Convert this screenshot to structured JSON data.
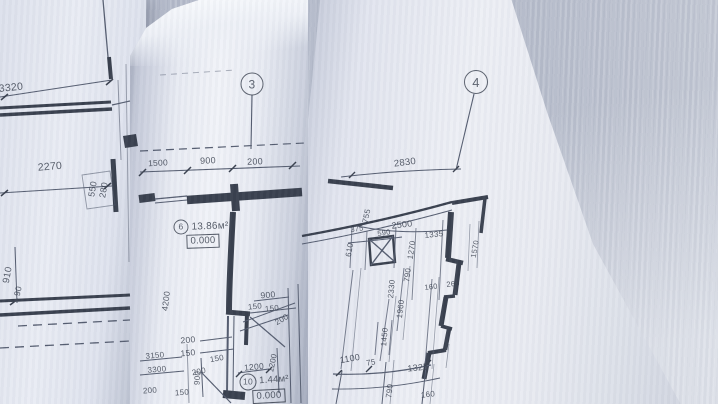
{
  "colors": {
    "background": "#b7bdcc",
    "paper_bright": "#f0f2f8",
    "paper": "#e7eaf3",
    "paper_shadow": "#a8aebf",
    "ink_dark": "#39404e",
    "ink_thin": "#555d70"
  },
  "sheets": {
    "left": {
      "labels": [
        {
          "text": "3320",
          "x": 11,
          "y": 88,
          "rot": -6,
          "size": 10.5
        },
        {
          "text": "2270",
          "x": 50,
          "y": 167,
          "rot": -5,
          "size": 10.5
        },
        {
          "text": "550",
          "x": 93,
          "y": 189,
          "rot": -80,
          "size": 9
        },
        {
          "text": "280",
          "x": 104,
          "y": 190,
          "rot": -80,
          "size": 9
        },
        {
          "text": "910",
          "x": 8,
          "y": 275,
          "rot": -80,
          "size": 9.5
        },
        {
          "text": "90",
          "x": 18,
          "y": 291,
          "rot": -78,
          "size": 8.5
        }
      ]
    },
    "middle": {
      "labels": [
        {
          "text": "3",
          "x": 252,
          "y": 84,
          "rot": 0,
          "size": 12,
          "kind": "axis",
          "d": 21,
          "name": "axis-marker-3"
        },
        {
          "text": "1500",
          "x": 158,
          "y": 163,
          "rot": -3,
          "size": 8.5
        },
        {
          "text": "900",
          "x": 208,
          "y": 161,
          "rot": -3,
          "size": 9
        },
        {
          "text": "200",
          "x": 255,
          "y": 162,
          "rot": -2,
          "size": 9
        },
        {
          "text": "6",
          "x": 181,
          "y": 227,
          "rot": 0,
          "size": 8.5,
          "kind": "circle",
          "d": 13,
          "name": "room-number-6"
        },
        {
          "text": "13.86м²",
          "x": 210,
          "y": 227,
          "rot": -2,
          "size": 10,
          "kind": "area",
          "name": "room-area-label"
        },
        {
          "text": "0.000",
          "x": 203,
          "y": 241,
          "rot": -2,
          "size": 9.5,
          "kind": "level",
          "name": "level-mark"
        },
        {
          "text": "4200",
          "x": 166,
          "y": 301,
          "rot": -83,
          "size": 8.5
        },
        {
          "text": "900",
          "x": 268,
          "y": 295,
          "rot": -5,
          "size": 8.5
        },
        {
          "text": "150",
          "x": 255,
          "y": 307,
          "rot": -5,
          "size": 8
        },
        {
          "text": "150",
          "x": 272,
          "y": 309,
          "rot": -5,
          "size": 8
        },
        {
          "text": "200",
          "x": 282,
          "y": 320,
          "rot": -30,
          "size": 8
        },
        {
          "text": "200",
          "x": 188,
          "y": 340,
          "rot": -5,
          "size": 8.5
        },
        {
          "text": "150",
          "x": 188,
          "y": 353,
          "rot": -5,
          "size": 8.5
        },
        {
          "text": "150",
          "x": 217,
          "y": 359,
          "rot": -10,
          "size": 8
        },
        {
          "text": "3150",
          "x": 155,
          "y": 356,
          "rot": -5,
          "size": 8
        },
        {
          "text": "3300",
          "x": 157,
          "y": 370,
          "rot": -5,
          "size": 8
        },
        {
          "text": "200",
          "x": 150,
          "y": 391,
          "rot": -4,
          "size": 8
        },
        {
          "text": "150",
          "x": 182,
          "y": 393,
          "rot": -4,
          "size": 8
        },
        {
          "text": "200",
          "x": 199,
          "y": 372,
          "rot": -12,
          "size": 8
        },
        {
          "text": "900",
          "x": 198,
          "y": 378,
          "rot": -85,
          "size": 8
        },
        {
          "text": "1200",
          "x": 254,
          "y": 367,
          "rot": -5,
          "size": 8.5
        },
        {
          "text": "1200",
          "x": 273,
          "y": 363,
          "rot": -78,
          "size": 8
        },
        {
          "text": "10",
          "x": 248,
          "y": 382,
          "rot": 0,
          "size": 8.5,
          "kind": "circle",
          "d": 15,
          "name": "room-number-10"
        },
        {
          "text": "1.44м²",
          "x": 274,
          "y": 380,
          "rot": -4,
          "size": 9.5,
          "kind": "area",
          "name": "room-area-label"
        },
        {
          "text": "0.000",
          "x": 269,
          "y": 396,
          "rot": -3,
          "size": 9.5,
          "kind": "level",
          "name": "level-mark"
        }
      ]
    },
    "right": {
      "labels": [
        {
          "text": "4",
          "x": 476,
          "y": 82,
          "rot": 0,
          "size": 13,
          "kind": "axis",
          "d": 22,
          "name": "axis-marker-4"
        },
        {
          "text": "2830",
          "x": 405,
          "y": 163,
          "rot": -7,
          "size": 9.5
        },
        {
          "text": "755",
          "x": 367,
          "y": 216,
          "rot": -78,
          "size": 8
        },
        {
          "text": "375",
          "x": 357,
          "y": 229,
          "rot": -8,
          "size": 7.5
        },
        {
          "text": "590",
          "x": 384,
          "y": 233,
          "rot": -8,
          "size": 7.5
        },
        {
          "text": "2500",
          "x": 402,
          "y": 225,
          "rot": -7,
          "size": 9
        },
        {
          "text": "1335",
          "x": 434,
          "y": 235,
          "rot": -6,
          "size": 8
        },
        {
          "text": "610",
          "x": 350,
          "y": 250,
          "rot": -80,
          "size": 8
        },
        {
          "text": "1270",
          "x": 412,
          "y": 250,
          "rot": -82,
          "size": 8
        },
        {
          "text": "790",
          "x": 408,
          "y": 275,
          "rot": -82,
          "size": 8
        },
        {
          "text": "2330",
          "x": 392,
          "y": 289,
          "rot": -85,
          "size": 8
        },
        {
          "text": "160",
          "x": 431,
          "y": 287,
          "rot": -7,
          "size": 7.5
        },
        {
          "text": "260",
          "x": 453,
          "y": 284,
          "rot": -7,
          "size": 7.5
        },
        {
          "text": "1570",
          "x": 475,
          "y": 249,
          "rot": -80,
          "size": 7.5
        },
        {
          "text": "1960",
          "x": 401,
          "y": 309,
          "rot": -83,
          "size": 8
        },
        {
          "text": "1450",
          "x": 385,
          "y": 337,
          "rot": -85,
          "size": 8
        },
        {
          "text": "1100",
          "x": 350,
          "y": 359,
          "rot": -10,
          "size": 9
        },
        {
          "text": "75",
          "x": 371,
          "y": 363,
          "rot": -10,
          "size": 8
        },
        {
          "text": "1325",
          "x": 418,
          "y": 368,
          "rot": -6,
          "size": 9
        },
        {
          "text": "790",
          "x": 390,
          "y": 391,
          "rot": -83,
          "size": 8
        },
        {
          "text": "160",
          "x": 428,
          "y": 395,
          "rot": -7,
          "size": 8
        }
      ]
    }
  }
}
